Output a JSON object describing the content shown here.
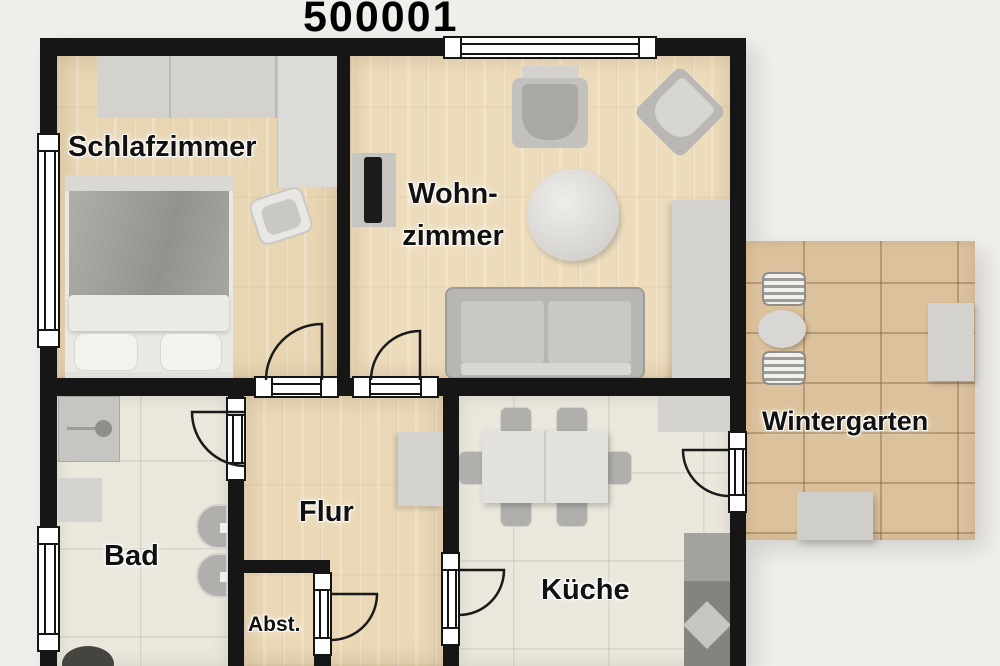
{
  "title": "500001",
  "rooms": {
    "schlafzimmer": {
      "label": "Schlafzimmer"
    },
    "wohnzimmer": {
      "label_line1": "Wohn-",
      "label_line2": "zimmer"
    },
    "wintergarten": {
      "label": "Wintergarten"
    },
    "bad": {
      "label": "Bad"
    },
    "flur": {
      "label": "Flur"
    },
    "kueche": {
      "label": "Küche"
    },
    "abstellraum": {
      "label": "Abst."
    }
  },
  "palette": {
    "background": "#f1efeb",
    "wall": "#161616",
    "wood_floor": "#e8d6b3",
    "tile_floor": "#eae7dc",
    "wintergarten_tile": "#dcc29c",
    "furniture_gray": "#cfcecb",
    "label_text": "#111111"
  }
}
